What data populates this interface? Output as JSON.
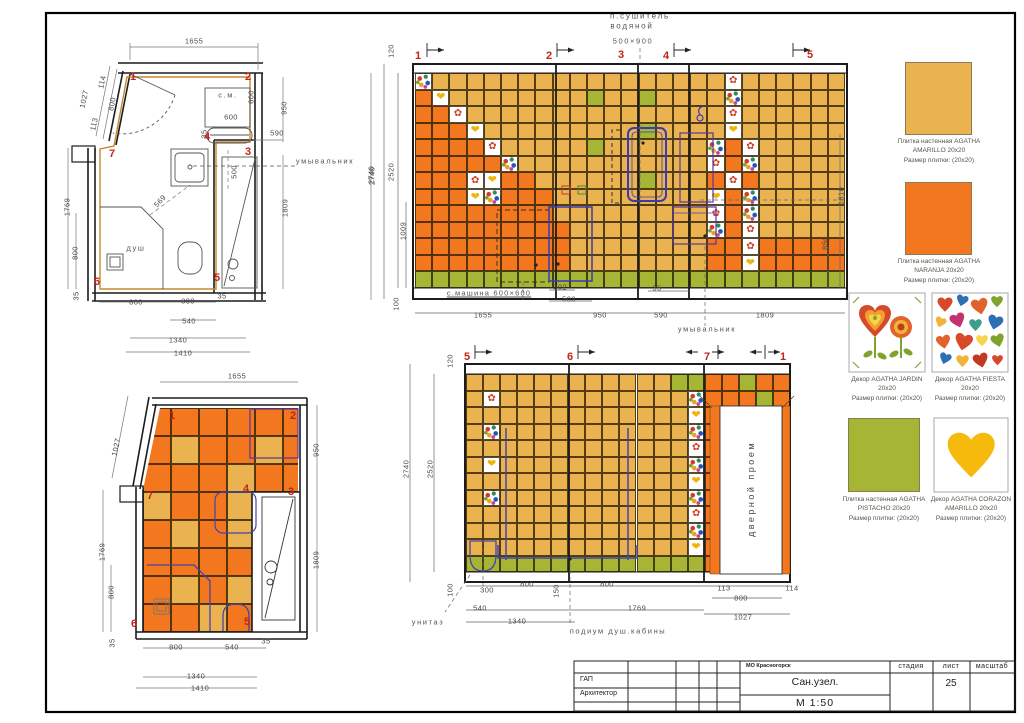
{
  "doc": {
    "object_title": "Сан.узел.",
    "scale": "М 1:50",
    "sheet_number": "25",
    "org": "МО Красногорск",
    "col_stage": "стадия",
    "col_sheet": "лист",
    "col_scale": "масштаб",
    "role_1": "ГАП",
    "role_2": "Архитектор"
  },
  "colors": {
    "amarillo": "#EAB350",
    "naranja": "#F2771E",
    "pistacho": "#A6B634",
    "marker_red": "#C22418",
    "fixture_blue": "#4444aa",
    "fixture_purple": "#5a35a0",
    "wall_black": "#1c1c1c",
    "tan_outline": "#C8872B"
  },
  "icons": {
    "jardin_glyph": "✿",
    "corazon_glyph": "❤",
    "jardin_icon": "flower-heart-decor",
    "fiesta_icon": "confetti-hearts-decor",
    "corazon_icon": "yellow-heart-decor"
  },
  "swatches": [
    {
      "id": "amarillo",
      "lines": [
        "Плитка настенная AGATHA",
        "AMARILLO 20x20",
        "Размер плитки: (20x20)"
      ]
    },
    {
      "id": "naranja",
      "lines": [
        "Плитка настенная AGATHA",
        "NARANJA 20x20",
        "Размер плитки: (20x20)"
      ]
    },
    {
      "id": "jardin",
      "lines": [
        "Декор AGATHA JARDIN",
        "20x20",
        "Размер плитки: (20x20)"
      ]
    },
    {
      "id": "fiesta",
      "lines": [
        "Декор AGATHA FIESTA",
        "20x20",
        "Размер плитки: (20x20)"
      ]
    },
    {
      "id": "pistacho",
      "lines": [
        "Плитка настенная AGATHA",
        "PISTACHO 20x20",
        "Размер плитки: (20x20)"
      ]
    },
    {
      "id": "corazon",
      "lines": [
        "Декор AGATHA CORAZON",
        "AMARILLO 20x20",
        "Размер плитки: (20x20)"
      ]
    }
  ],
  "tile_maps": {
    "elev_top": {
      "x": 415,
      "y": 73,
      "tw": 17.2,
      "th": 16.54,
      "rows": [
        "FAAAAAAAAAAAAAAAAAJAAAAAA",
        "NCAAAAAAAAPAAPAAAAFAAAAAA",
        "NNJAAAAAAAAAAAAAAAJAAAAAA",
        "NNNCAAAAAAAAAPAAAACAAAAAA",
        "NNNNJAAAAAPAAAAAAFNJAAAAA",
        "NNNNNFAAAAAAAAAAAJNFAAAAA",
        "NNNJCNNAAAAAAPAAANJNAAAAA",
        "NNNCFNNNAAAAAAAAACNFAAAAA",
        "NNNNNNNNAAAAAAAAAJNFAAAAA",
        "NNNNNNNNNAAAAAAAAFNJAAAAA",
        "NNNNNNNNNAAAAAAAANNJNNNNN",
        "NNNNNNNNNAAAAAAAANNCNNNNN",
        "PPPPPPPPPPPPPPPPPPPPPPPPP"
      ]
    },
    "elev_bottom": {
      "x": 466,
      "y": 374,
      "tw": 17.05,
      "th": 16.5,
      "rows": [
        "AAAAAAAAAAAAPPNNPNN",
        "AJAAAAAAAAAAAFNNNPN",
        "AAAAAAAAAAAAACNNNNN",
        "AFAAAAAAAAAAAFNNNNN",
        "AAAAAAAAAAAAAJNNNNN",
        "ACAAAAAAAAAAAFNNNNN",
        "AAAAAAAAAAAAACNNNNN",
        "AFAAAAAAAAAAAFNNNNN",
        "AAAAAAAAAAAAAJNNNNN",
        "AAAAAAAAAAAAAFNNNNN",
        "AAAAAAAAAAAAACNNNNN",
        "PPPPPPPPPPPPPPNNNNP"
      ]
    },
    "plan_bottom": {
      "x": 143,
      "y": 408,
      "tw": 28,
      "th": 28,
      "clip": "polygon(17px 0px, 155px 0px, 155px 84px, 109px 84px, 109px 224px, 0px 224px, 0px 82px)",
      "rows": [
        "NNNNNN",
        "NANNAN",
        "NNNANN",
        "ANNANN",
        "NANANN",
        "NNNNNN",
        "NANANN",
        "NNANNN"
      ]
    }
  },
  "labels": {
    "plan_top": [
      [
        "1655",
        194,
        41
      ],
      [
        "1027",
        84,
        99,
        -78
      ],
      [
        "114",
        102,
        82,
        -78
      ],
      [
        "800",
        112,
        104,
        -78
      ],
      [
        "113",
        94,
        124,
        -78
      ],
      [
        "950",
        284,
        108,
        -90
      ],
      [
        "590",
        277,
        133
      ],
      [
        "2740",
        371,
        175,
        -90
      ],
      [
        "1809",
        285,
        208,
        -90
      ],
      [
        "1769",
        67,
        207,
        -90
      ],
      [
        "800",
        75,
        253,
        -90
      ],
      [
        "35",
        76,
        296,
        -90
      ],
      [
        "800",
        136,
        302
      ],
      [
        "300",
        188,
        301
      ],
      [
        "35",
        222,
        296
      ],
      [
        "540",
        189,
        321
      ],
      [
        "1340",
        178,
        340
      ],
      [
        "1410",
        183,
        353
      ],
      [
        "с.м.",
        228,
        95,
        0,
        "note"
      ],
      [
        "600",
        251,
        97,
        -90
      ],
      [
        "600",
        231,
        117
      ],
      [
        "35",
        204,
        134,
        -90
      ],
      [
        "500",
        234,
        172,
        -90
      ],
      [
        "569",
        160,
        201,
        -48
      ],
      [
        "умывальник",
        325,
        161,
        0,
        "note"
      ],
      [
        "душ",
        136,
        248,
        0,
        "note"
      ],
      [
        "1",
        133,
        77,
        0,
        "mk"
      ],
      [
        "2",
        248,
        77,
        0,
        "mk"
      ],
      [
        "3",
        248,
        152,
        0,
        "mk"
      ],
      [
        "4",
        207,
        137,
        0,
        "mk"
      ],
      [
        "5",
        217,
        278,
        0,
        "mk"
      ],
      [
        "6",
        97,
        282,
        0,
        "mk"
      ],
      [
        "7",
        112,
        154,
        0,
        "mk"
      ]
    ],
    "plan_bottom": [
      [
        "1655",
        237,
        376
      ],
      [
        "1027",
        116,
        447,
        -78
      ],
      [
        "950",
        316,
        450,
        -90
      ],
      [
        "1809",
        316,
        560,
        -90
      ],
      [
        "1769",
        102,
        552,
        -90
      ],
      [
        "800",
        111,
        592,
        -90
      ],
      [
        "35",
        112,
        643,
        -90
      ],
      [
        "800",
        176,
        647
      ],
      [
        "540",
        232,
        647
      ],
      [
        "35",
        266,
        641
      ],
      [
        "1340",
        196,
        676
      ],
      [
        "1410",
        200,
        688
      ],
      [
        "1",
        172,
        416,
        0,
        "mk"
      ],
      [
        "2",
        293,
        416,
        0,
        "mk"
      ],
      [
        "3",
        291,
        492,
        0,
        "mk"
      ],
      [
        "4",
        246,
        489,
        0,
        "mk"
      ],
      [
        "5",
        247,
        622,
        0,
        "mk"
      ],
      [
        "6",
        134,
        624,
        0,
        "mk"
      ],
      [
        "7",
        150,
        496,
        0,
        "mk"
      ]
    ],
    "elev_top": [
      [
        "п.сушитель",
        640,
        16,
        0,
        "hdr"
      ],
      [
        "водяной",
        632,
        26,
        0,
        "hdr"
      ],
      [
        "500×900",
        633,
        41,
        0,
        "note"
      ],
      [
        "1",
        418,
        56,
        0,
        "mk"
      ],
      [
        "2",
        549,
        56,
        0,
        "mk"
      ],
      [
        "3",
        621,
        55,
        0,
        "mk"
      ],
      [
        "4",
        666,
        56,
        0,
        "mk"
      ],
      [
        "5",
        810,
        55,
        0,
        "mk"
      ],
      [
        "120",
        391,
        51,
        -90
      ],
      [
        "2740",
        372,
        176,
        -90
      ],
      [
        "2520",
        391,
        172,
        -90
      ],
      [
        "1009",
        403,
        231,
        -90
      ],
      [
        "100",
        396,
        304,
        -90
      ],
      [
        "1810",
        841,
        196,
        -90
      ],
      [
        "850",
        825,
        243,
        -90
      ],
      [
        "302",
        560,
        287
      ],
      [
        "503",
        569,
        299
      ],
      [
        "35",
        657,
        288
      ],
      [
        "с.машина 600×600",
        489,
        293,
        0,
        "noteu"
      ],
      [
        "1655",
        483,
        315
      ],
      [
        "950",
        600,
        315
      ],
      [
        "590",
        661,
        315
      ],
      [
        "1809",
        765,
        315
      ],
      [
        "умывальник",
        707,
        329,
        0,
        "note"
      ]
    ],
    "elev_bottom": [
      [
        "5",
        467,
        357,
        0,
        "mk"
      ],
      [
        "6",
        570,
        357,
        0,
        "mk"
      ],
      [
        "7",
        707,
        357,
        0,
        "mk"
      ],
      [
        "1",
        783,
        357,
        0,
        "mk"
      ],
      [
        "120",
        450,
        361,
        -90
      ],
      [
        "2740",
        406,
        469,
        -90
      ],
      [
        "2520",
        430,
        469,
        -90
      ],
      [
        "100",
        450,
        590,
        -90
      ],
      [
        "300",
        487,
        590
      ],
      [
        "540",
        480,
        608
      ],
      [
        "1340",
        517,
        621
      ],
      [
        "800",
        527,
        584
      ],
      [
        "150",
        556,
        591,
        -90
      ],
      [
        "800",
        607,
        584
      ],
      [
        "1769",
        637,
        608
      ],
      [
        "113",
        724,
        588
      ],
      [
        "800",
        741,
        598
      ],
      [
        "114",
        792,
        588
      ],
      [
        "1027",
        743,
        617
      ],
      [
        "унитаз",
        428,
        622,
        0,
        "note"
      ],
      [
        "подиум душ.кабины",
        618,
        631,
        0,
        "note"
      ],
      [
        "дверной проем",
        751,
        489,
        -90,
        "door"
      ]
    ]
  }
}
